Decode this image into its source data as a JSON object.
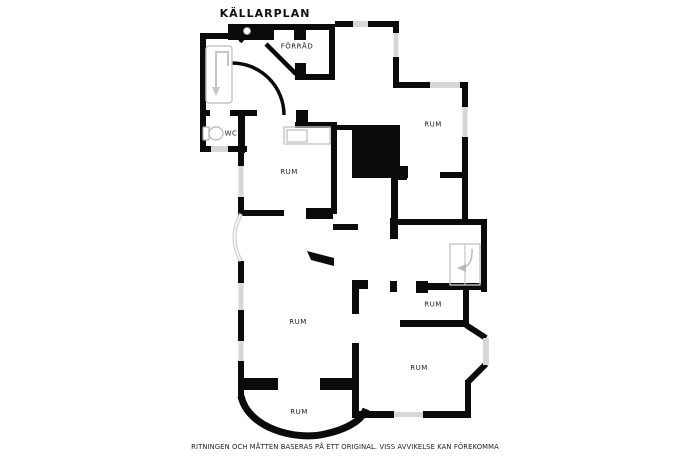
{
  "title": "KÄLLARPLAN",
  "disclaimer": "RITNINGEN OCH MÅTTEN BASERAS PÅ ETT ORIGINAL. VISS AVVIKELSE KAN FÖREKOMMA",
  "plan_type": "basement-floor-plan",
  "rooms": [
    {
      "id": "forrad",
      "label": "FÖRRÅD"
    },
    {
      "id": "wc",
      "label": "WC"
    },
    {
      "id": "rum-center",
      "label": "RUM"
    },
    {
      "id": "rum-top-right",
      "label": "RUM"
    },
    {
      "id": "rum-by-stairs",
      "label": "RUM"
    },
    {
      "id": "rum-large",
      "label": "RUM"
    },
    {
      "id": "rum-bottom-right",
      "label": "RUM"
    },
    {
      "id": "rum-bottom",
      "label": "RUM"
    }
  ],
  "fixtures": [
    {
      "name": "stairs-down-arrow-icon",
      "location": "entry-hall"
    },
    {
      "name": "boiler-icon",
      "location": "entry-hall"
    },
    {
      "name": "toilet-icon",
      "location": "wc"
    },
    {
      "name": "sink-counter-icon",
      "location": "rum-center"
    },
    {
      "name": "staircase-turn-arrow-icon",
      "location": "stair-hall"
    }
  ],
  "colors": {
    "background": "#ffffff",
    "wall": "#0b0b0b",
    "window": "#d7d7d7",
    "fixture_stroke": "#c5c5c5",
    "text": "#1d1d1d"
  }
}
